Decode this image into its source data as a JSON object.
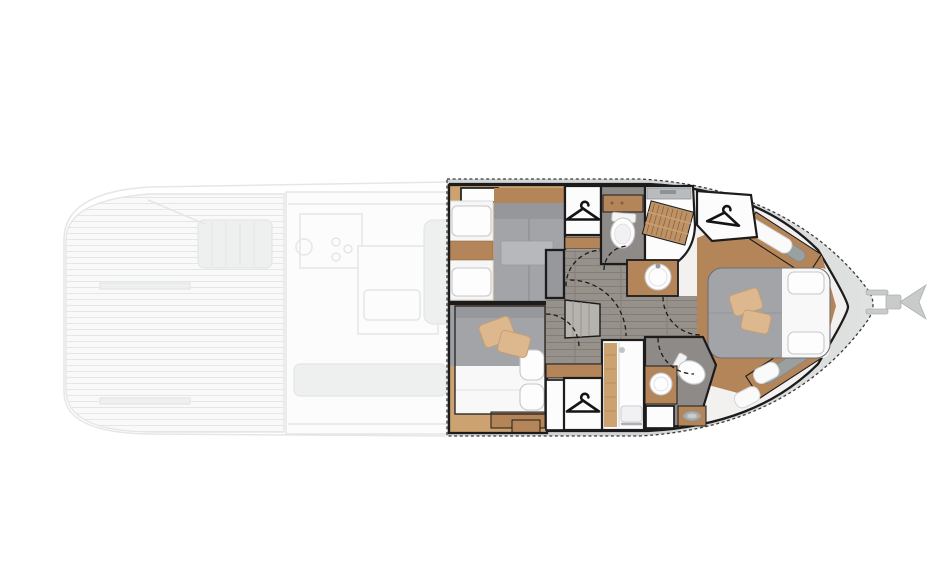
{
  "scene": {
    "kind": "motor-yacht floor plan, top view, bow pointing right",
    "visible_text": [],
    "sections": [
      {
        "id": "main-deck-aft",
        "style": "ghosted / faded",
        "contents": [
          "swim platform with plank decking",
          "cockpit bench",
          "galley with stove burners",
          "island counter with sink",
          "salon sofa"
        ]
      },
      {
        "id": "lower-deck-cabins",
        "style": "full color highlight",
        "contents": [
          "twin-bed guest cabin",
          "vip double-bed cabin",
          "guest bathroom with toilet",
          "shower with teak grate",
          "round washbasins",
          "master island-bed cabin in bow",
          "three wardrobes marked with hanger icons",
          "companionway stairs",
          "dashed door-swing arcs",
          "bow anchor roller fitting"
        ]
      }
    ]
  },
  "icons": {
    "hanger": {
      "name": "hanger-icon",
      "count": 3,
      "color": "#141414"
    },
    "anchor_roller": {
      "name": "anchor-roller-icon",
      "count": 1,
      "color": "#c8cbca"
    }
  },
  "colors": {
    "background": "#ffffff",
    "hull_deck": "#d3d6d4",
    "hull_deck_light": "#dfe2e0",
    "outline": "#1c1c1c",
    "corridor_floor": "#97918c",
    "corridor_plank": "#847d77",
    "bath_floor": "#8e8a87",
    "wood": "#b5855a",
    "wood_light": "#cda271",
    "teak_grate": "#bf9266",
    "teak_line": "#7d5f3e",
    "bed_gray": "#a3a4a8",
    "bedding_white": "#f8f8f9",
    "pillow_tan": "#ddb88f",
    "fixture_white": "#fdfdfe",
    "ghost_line": "#e0e3e2",
    "ghost_mid": "#eceeed",
    "icon_black": "#141414"
  }
}
